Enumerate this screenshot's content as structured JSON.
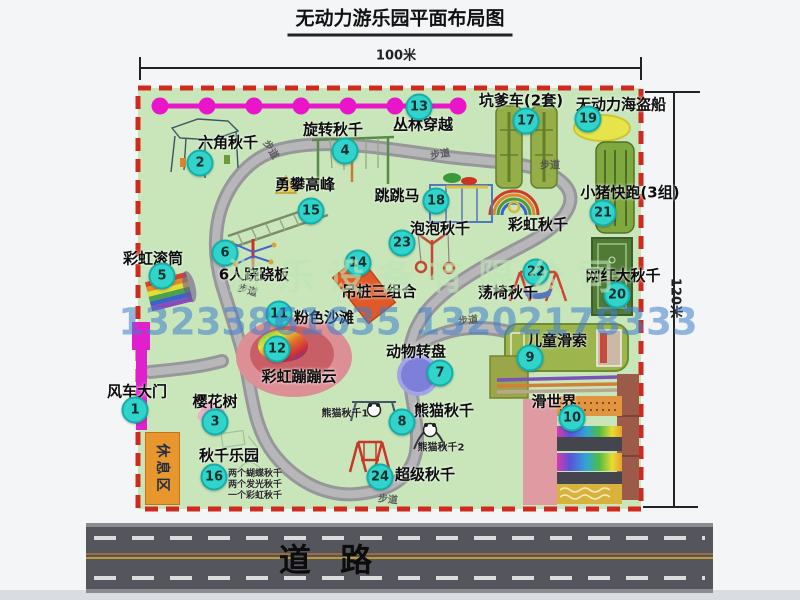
{
  "title": "无动力游乐园平面布局图",
  "dimensions": {
    "width": "100米",
    "height": "120米"
  },
  "map": {
    "path_label": "步道",
    "rest_area": "休息区",
    "rainbow_swing": "彩虹秋千",
    "panda_swing_1": "熊猫秋千1",
    "panda_swing_2": "熊猫秋千2",
    "swing_park_details": [
      "两个蝴蝶秋千",
      "两个发光秋千",
      "一个彩虹秋千"
    ],
    "pois": [
      {
        "num": "1",
        "label": "风车大门"
      },
      {
        "num": "2",
        "label": "六角秋千"
      },
      {
        "num": "3",
        "label": "樱花树"
      },
      {
        "num": "4",
        "label": "旋转秋千"
      },
      {
        "num": "5",
        "label": "彩虹滚筒"
      },
      {
        "num": "6",
        "label": "6人跷跷板"
      },
      {
        "num": "7",
        "label": "动物转盘"
      },
      {
        "num": "8",
        "label": "熊猫秋千"
      },
      {
        "num": "9",
        "label": "儿童滑索"
      },
      {
        "num": "10",
        "label": "滑世界"
      },
      {
        "num": "11",
        "label": "粉色沙滩"
      },
      {
        "num": "12",
        "label": "彩虹蹦蹦云"
      },
      {
        "num": "13",
        "label": "丛林穿越"
      },
      {
        "num": "14",
        "label": "吊桩三组合"
      },
      {
        "num": "15",
        "label": "勇攀高峰"
      },
      {
        "num": "16",
        "label": "秋千乐园"
      },
      {
        "num": "17",
        "label": "坑爹车(2套)"
      },
      {
        "num": "18",
        "label": "跳跳马"
      },
      {
        "num": "19",
        "label": "无动力海盗船"
      },
      {
        "num": "20",
        "label": "网红大秋千"
      },
      {
        "num": "21",
        "label": "小猪快跑(3组)"
      },
      {
        "num": "22",
        "label": "荡椅秋千"
      },
      {
        "num": "23",
        "label": "泡泡秋千"
      },
      {
        "num": "24",
        "label": "超级秋千"
      }
    ]
  },
  "watermark": {
    "company": "游乐设备有限公司",
    "phone": "13233861635 13202178333"
  },
  "road": {
    "label": "道 路"
  },
  "colors": {
    "map_bg": "#c8e6ba",
    "border_red": "#cf2a1d",
    "badge_cyan": "#31d4cb",
    "chain_magenta": "#e816c8",
    "gate_magenta": "#e020cc",
    "rest_orange": "#e8962e",
    "road_gray": "#55555d"
  }
}
